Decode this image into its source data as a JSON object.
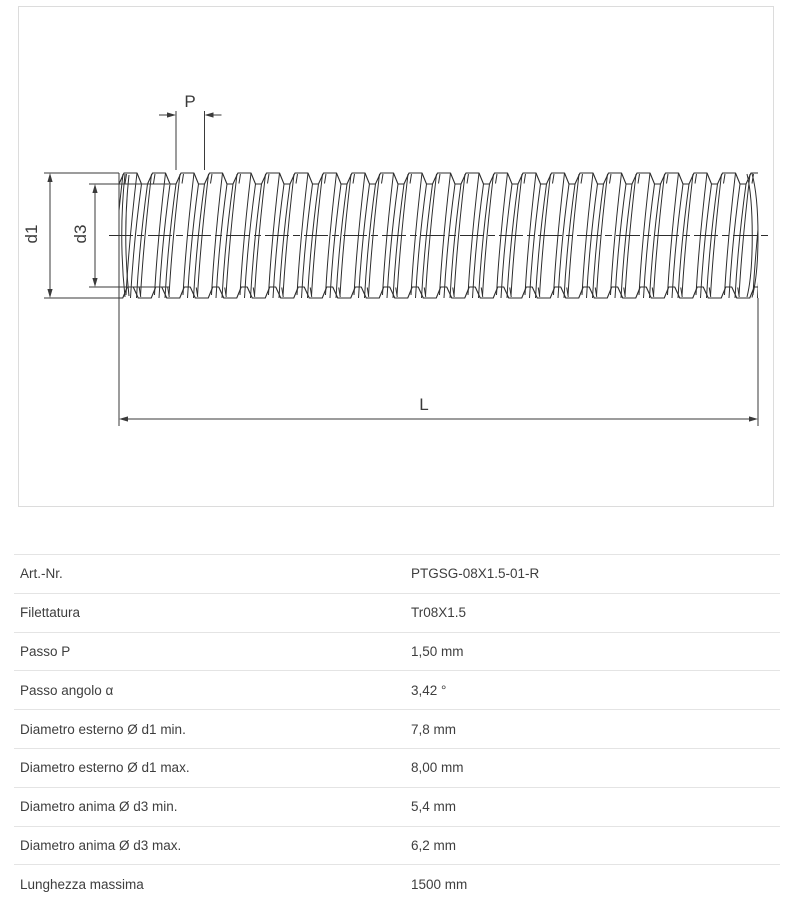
{
  "drawing": {
    "labels": {
      "pitch": "P",
      "outer_diameter": "d1",
      "core_diameter": "d3",
      "length": "L"
    }
  },
  "table": {
    "rows": [
      {
        "label": "Art.-Nr.",
        "value": "PTGSG-08X1.5-01-R"
      },
      {
        "label": "Filettatura",
        "value": "Tr08X1.5"
      },
      {
        "label": "Passo P",
        "value": "1,50 mm"
      },
      {
        "label": "Passo angolo α",
        "value": "3,42 °"
      },
      {
        "label": "Diametro esterno Ø d1 min.",
        "value": "7,8 mm"
      },
      {
        "label": "Diametro esterno Ø d1 max.",
        "value": "8,00 mm"
      },
      {
        "label": "Diametro anima Ø d3 min.",
        "value": "5,4 mm"
      },
      {
        "label": "Diametro anima Ø d3 max.",
        "value": "6,2 mm"
      },
      {
        "label": "Lunghezza massima",
        "value": "1500 mm"
      }
    ]
  },
  "colors": {
    "line": "#2d2d2d",
    "dim": "#3a3a3a",
    "panel_border": "#dcdcdc",
    "separator": "#e4e4e4",
    "text": "#3e3e3e"
  }
}
